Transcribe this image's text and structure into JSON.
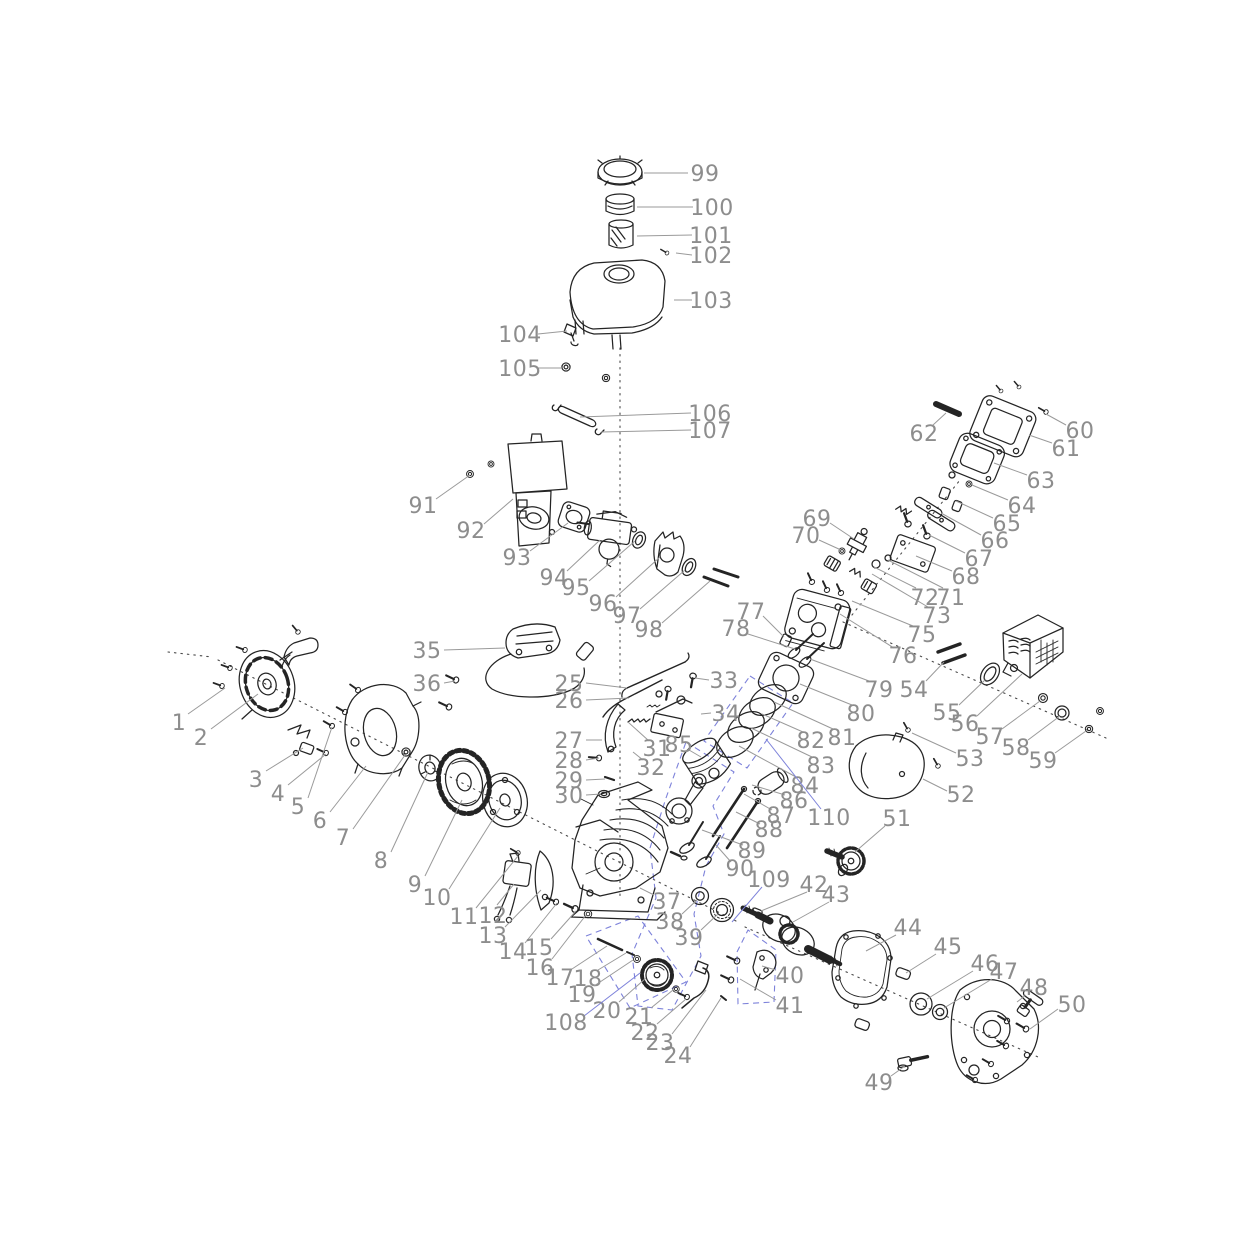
{
  "figure": {
    "visible_text_type": "part-numbers-only"
  },
  "colors": {
    "background": "#ffffff",
    "ink": "#242424",
    "label": "#8d8d8d",
    "leader": "#9a9a9a",
    "blue": "#7d82da",
    "centerline": "#4a4a4a"
  },
  "callouts": [
    {
      "n": "1",
      "x": 179,
      "y": 722,
      "line": [
        188,
        714,
        225,
        688
      ]
    },
    {
      "n": "2",
      "x": 201,
      "y": 737,
      "line": [
        211,
        729,
        258,
        694
      ]
    },
    {
      "n": "3",
      "x": 256,
      "y": 779,
      "line": [
        266,
        771,
        303,
        748
      ]
    },
    {
      "n": "4",
      "x": 278,
      "y": 793,
      "line": [
        288,
        785,
        326,
        754
      ]
    },
    {
      "n": "5",
      "x": 298,
      "y": 806,
      "line": [
        308,
        798,
        332,
        727
      ]
    },
    {
      "n": "6",
      "x": 320,
      "y": 820,
      "line": [
        330,
        812,
        366,
        766
      ]
    },
    {
      "n": "7",
      "x": 343,
      "y": 837,
      "line": [
        353,
        829,
        405,
        755
      ]
    },
    {
      "n": "8",
      "x": 381,
      "y": 860,
      "line": [
        391,
        852,
        428,
        772
      ]
    },
    {
      "n": "9",
      "x": 415,
      "y": 884,
      "line": [
        425,
        876,
        462,
        800
      ]
    },
    {
      "n": "10",
      "x": 437,
      "y": 897,
      "line": [
        449,
        889,
        500,
        808
      ]
    },
    {
      "n": "11",
      "x": 464,
      "y": 916,
      "line": [
        476,
        908,
        518,
        856
      ]
    },
    {
      "n": "12",
      "x": 493,
      "y": 915,
      "line": [
        497,
        905,
        514,
        884
      ]
    },
    {
      "n": "13",
      "x": 493,
      "y": 935,
      "line": [
        505,
        927,
        541,
        890
      ]
    },
    {
      "n": "14",
      "x": 513,
      "y": 951,
      "line": [
        525,
        943,
        557,
        903
      ]
    },
    {
      "n": "15",
      "x": 539,
      "y": 947,
      "line": [
        551,
        939,
        576,
        911
      ]
    },
    {
      "n": "16",
      "x": 540,
      "y": 967,
      "line": [
        552,
        959,
        586,
        915
      ]
    },
    {
      "n": "17",
      "x": 560,
      "y": 977,
      "line": [
        572,
        969,
        607,
        946
      ]
    },
    {
      "n": "18",
      "x": 588,
      "y": 978,
      "line": [
        598,
        970,
        626,
        953
      ]
    },
    {
      "n": "19",
      "x": 582,
      "y": 994,
      "line": [
        594,
        986,
        633,
        960
      ]
    },
    {
      "n": "20",
      "x": 607,
      "y": 1010,
      "line": [
        619,
        1002,
        646,
        978
      ]
    },
    {
      "n": "21",
      "x": 639,
      "y": 1016,
      "line": [
        651,
        1008,
        673,
        990
      ]
    },
    {
      "n": "22",
      "x": 645,
      "y": 1032,
      "line": [
        657,
        1024,
        686,
        999
      ]
    },
    {
      "n": "23",
      "x": 660,
      "y": 1042,
      "line": [
        672,
        1034,
        706,
        990
      ]
    },
    {
      "n": "24",
      "x": 678,
      "y": 1055,
      "line": [
        690,
        1047,
        721,
        998
      ]
    },
    {
      "n": "25",
      "x": 569,
      "y": 683,
      "line": [
        586,
        683,
        627,
        688
      ]
    },
    {
      "n": "26",
      "x": 569,
      "y": 700,
      "line": [
        586,
        700,
        629,
        698
      ]
    },
    {
      "n": "27",
      "x": 569,
      "y": 740,
      "line": [
        586,
        740,
        602,
        740
      ]
    },
    {
      "n": "28",
      "x": 569,
      "y": 760,
      "line": [
        586,
        760,
        599,
        758
      ]
    },
    {
      "n": "29",
      "x": 569,
      "y": 780,
      "line": [
        586,
        780,
        605,
        779
      ]
    },
    {
      "n": "30",
      "x": 569,
      "y": 795,
      "line": [
        586,
        795,
        601,
        794
      ]
    },
    {
      "n": "31",
      "x": 657,
      "y": 748,
      "line": [
        649,
        741,
        628,
        722
      ]
    },
    {
      "n": "32",
      "x": 651,
      "y": 767,
      "line": [
        643,
        760,
        633,
        752
      ]
    },
    {
      "n": "33",
      "x": 724,
      "y": 680,
      "line": [
        709,
        680,
        695,
        678
      ]
    },
    {
      "n": "34",
      "x": 726,
      "y": 713,
      "line": [
        711,
        713,
        701,
        714
      ]
    },
    {
      "n": "35",
      "x": 427,
      "y": 650,
      "line": [
        444,
        650,
        505,
        648
      ]
    },
    {
      "n": "36",
      "x": 427,
      "y": 683,
      "line": [
        444,
        683,
        455,
        681
      ]
    },
    {
      "n": "37",
      "x": 667,
      "y": 901,
      "line": [
        654,
        895,
        640,
        888
      ]
    },
    {
      "n": "38",
      "x": 670,
      "y": 921,
      "line": [
        682,
        914,
        697,
        900
      ]
    },
    {
      "n": "39",
      "x": 689,
      "y": 937,
      "line": [
        701,
        930,
        718,
        914
      ]
    },
    {
      "n": "40",
      "x": 790,
      "y": 975,
      "line": [
        776,
        970,
        762,
        966
      ]
    },
    {
      "n": "41",
      "x": 790,
      "y": 1005,
      "line": [
        776,
        1000,
        740,
        979
      ]
    },
    {
      "n": "42",
      "x": 814,
      "y": 884,
      "line": [
        807,
        892,
        761,
        911
      ]
    },
    {
      "n": "43",
      "x": 836,
      "y": 894,
      "line": [
        829,
        902,
        793,
        922
      ]
    },
    {
      "n": "44",
      "x": 908,
      "y": 927,
      "line": [
        896,
        935,
        866,
        951
      ]
    },
    {
      "n": "45",
      "x": 948,
      "y": 946,
      "line": [
        936,
        954,
        906,
        973
      ]
    },
    {
      "n": "46",
      "x": 985,
      "y": 963,
      "line": [
        973,
        971,
        927,
        999
      ]
    },
    {
      "n": "47",
      "x": 1004,
      "y": 971,
      "line": [
        992,
        979,
        944,
        1008
      ]
    },
    {
      "n": "48",
      "x": 1034,
      "y": 987,
      "line": [
        1026,
        995,
        1017,
        1002
      ]
    },
    {
      "n": "49",
      "x": 879,
      "y": 1082,
      "line": [
        891,
        1076,
        905,
        1066
      ]
    },
    {
      "n": "50",
      "x": 1072,
      "y": 1004,
      "line": [
        1058,
        1009,
        1030,
        1029
      ]
    },
    {
      "n": "51",
      "x": 897,
      "y": 818,
      "line": [
        885,
        826,
        855,
        852
      ]
    },
    {
      "n": "52",
      "x": 961,
      "y": 794,
      "line": [
        947,
        791,
        923,
        779
      ]
    },
    {
      "n": "53",
      "x": 970,
      "y": 758,
      "line": [
        956,
        753,
        912,
        733
      ]
    },
    {
      "n": "54",
      "x": 914,
      "y": 689,
      "line": [
        926,
        681,
        944,
        662
      ]
    },
    {
      "n": "55",
      "x": 947,
      "y": 712,
      "line": [
        959,
        705,
        986,
        679
      ]
    },
    {
      "n": "56",
      "x": 965,
      "y": 723,
      "line": [
        977,
        716,
        1022,
        674
      ]
    },
    {
      "n": "57",
      "x": 990,
      "y": 736,
      "line": [
        1002,
        729,
        1040,
        701
      ]
    },
    {
      "n": "58",
      "x": 1016,
      "y": 747,
      "line": [
        1028,
        740,
        1060,
        716
      ]
    },
    {
      "n": "59",
      "x": 1043,
      "y": 760,
      "line": [
        1055,
        753,
        1086,
        731
      ]
    },
    {
      "n": "60",
      "x": 1080,
      "y": 430,
      "line": [
        1066,
        425,
        1046,
        414
      ]
    },
    {
      "n": "61",
      "x": 1066,
      "y": 448,
      "line": [
        1052,
        443,
        1029,
        435
      ]
    },
    {
      "n": "62",
      "x": 924,
      "y": 433,
      "line": [
        933,
        425,
        946,
        413
      ]
    },
    {
      "n": "63",
      "x": 1041,
      "y": 480,
      "line": [
        1027,
        475,
        994,
        463
      ]
    },
    {
      "n": "64",
      "x": 1022,
      "y": 505,
      "line": [
        1008,
        500,
        972,
        485
      ]
    },
    {
      "n": "65",
      "x": 1007,
      "y": 523,
      "line": [
        993,
        518,
        956,
        501
      ]
    },
    {
      "n": "66",
      "x": 995,
      "y": 540,
      "line": [
        981,
        535,
        941,
        513
      ]
    },
    {
      "n": "67",
      "x": 979,
      "y": 558,
      "line": [
        965,
        553,
        929,
        535
      ]
    },
    {
      "n": "68",
      "x": 966,
      "y": 576,
      "line": [
        952,
        571,
        916,
        556
      ]
    },
    {
      "n": "69",
      "x": 817,
      "y": 518,
      "line": [
        830,
        523,
        854,
        539
      ]
    },
    {
      "n": "70",
      "x": 806,
      "y": 535,
      "line": [
        819,
        540,
        841,
        550
      ]
    },
    {
      "n": "71",
      "x": 951,
      "y": 597,
      "line": [
        943,
        588,
        888,
        560
      ]
    },
    {
      "n": "72",
      "x": 925,
      "y": 597,
      "line": [
        916,
        588,
        874,
        567
      ]
    },
    {
      "n": "73",
      "x": 937,
      "y": 615,
      "line": [
        928,
        607,
        872,
        574
      ]
    },
    {
      "n": "75",
      "x": 922,
      "y": 634,
      "line": [
        913,
        626,
        852,
        601
      ]
    },
    {
      "n": "76",
      "x": 903,
      "y": 655,
      "line": [
        894,
        648,
        840,
        614
      ]
    },
    {
      "n": "77",
      "x": 751,
      "y": 611,
      "line": [
        763,
        616,
        784,
        637
      ]
    },
    {
      "n": "78",
      "x": 736,
      "y": 628,
      "line": [
        748,
        634,
        795,
        649
      ]
    },
    {
      "n": "79",
      "x": 879,
      "y": 689,
      "line": [
        869,
        681,
        810,
        659
      ]
    },
    {
      "n": "80",
      "x": 861,
      "y": 713,
      "line": [
        852,
        705,
        800,
        684
      ]
    },
    {
      "n": "81",
      "x": 842,
      "y": 737,
      "line": [
        833,
        729,
        774,
        702
      ]
    },
    {
      "n": "82",
      "x": 811,
      "y": 740,
      "line": [
        803,
        732,
        762,
        714
      ]
    },
    {
      "n": "83",
      "x": 821,
      "y": 765,
      "line": [
        812,
        757,
        751,
        728
      ]
    },
    {
      "n": "84",
      "x": 805,
      "y": 785,
      "line": [
        796,
        777,
        739,
        746
      ]
    },
    {
      "n": "85",
      "x": 679,
      "y": 744,
      "line": [
        689,
        750,
        701,
        757
      ]
    },
    {
      "n": "86",
      "x": 794,
      "y": 800,
      "line": [
        785,
        795,
        752,
        785
      ]
    },
    {
      "n": "87",
      "x": 781,
      "y": 815,
      "line": [
        772,
        810,
        744,
        794
      ]
    },
    {
      "n": "88",
      "x": 769,
      "y": 829,
      "line": [
        760,
        824,
        736,
        812
      ]
    },
    {
      "n": "89",
      "x": 752,
      "y": 850,
      "line": [
        743,
        845,
        702,
        830
      ]
    },
    {
      "n": "90",
      "x": 740,
      "y": 868,
      "line": [
        731,
        862,
        716,
        845
      ]
    },
    {
      "n": "91",
      "x": 423,
      "y": 505,
      "line": [
        436,
        499,
        470,
        475
      ]
    },
    {
      "n": "92",
      "x": 471,
      "y": 530,
      "line": [
        484,
        524,
        513,
        499
      ]
    },
    {
      "n": "93",
      "x": 517,
      "y": 557,
      "line": [
        530,
        551,
        568,
        523
      ]
    },
    {
      "n": "94",
      "x": 554,
      "y": 577,
      "line": [
        567,
        571,
        600,
        540
      ]
    },
    {
      "n": "95",
      "x": 576,
      "y": 587,
      "line": [
        589,
        581,
        635,
        541
      ]
    },
    {
      "n": "96",
      "x": 603,
      "y": 603,
      "line": [
        616,
        597,
        660,
        557
      ]
    },
    {
      "n": "97",
      "x": 627,
      "y": 615,
      "line": [
        640,
        609,
        685,
        570
      ]
    },
    {
      "n": "98",
      "x": 649,
      "y": 629,
      "line": [
        662,
        623,
        710,
        581
      ]
    },
    {
      "n": "99",
      "x": 705,
      "y": 173,
      "line": [
        688,
        173,
        644,
        173
      ]
    },
    {
      "n": "100",
      "x": 712,
      "y": 207,
      "line": [
        693,
        207,
        637,
        207
      ]
    },
    {
      "n": "101",
      "x": 711,
      "y": 235,
      "line": [
        692,
        235,
        637,
        236
      ]
    },
    {
      "n": "102",
      "x": 711,
      "y": 255,
      "line": [
        692,
        255,
        676,
        253
      ]
    },
    {
      "n": "103",
      "x": 711,
      "y": 300,
      "line": [
        692,
        300,
        674,
        300
      ]
    },
    {
      "n": "104",
      "x": 520,
      "y": 334,
      "line": [
        538,
        334,
        567,
        331
      ]
    },
    {
      "n": "105",
      "x": 520,
      "y": 368,
      "line": [
        538,
        368,
        562,
        368
      ]
    },
    {
      "n": "106",
      "x": 710,
      "y": 413,
      "line": [
        691,
        413,
        580,
        417
      ]
    },
    {
      "n": "107",
      "x": 710,
      "y": 430,
      "line": [
        691,
        430,
        601,
        432
      ]
    },
    {
      "n": "108",
      "x": 566,
      "y": 1022,
      "blue": true,
      "line": [
        584,
        1016,
        640,
        973
      ]
    },
    {
      "n": "109",
      "x": 769,
      "y": 879,
      "blue": true,
      "line": [
        762,
        887,
        732,
        922
      ]
    },
    {
      "n": "110",
      "x": 829,
      "y": 817,
      "blue": true,
      "line": [
        821,
        809,
        766,
        739
      ]
    }
  ]
}
